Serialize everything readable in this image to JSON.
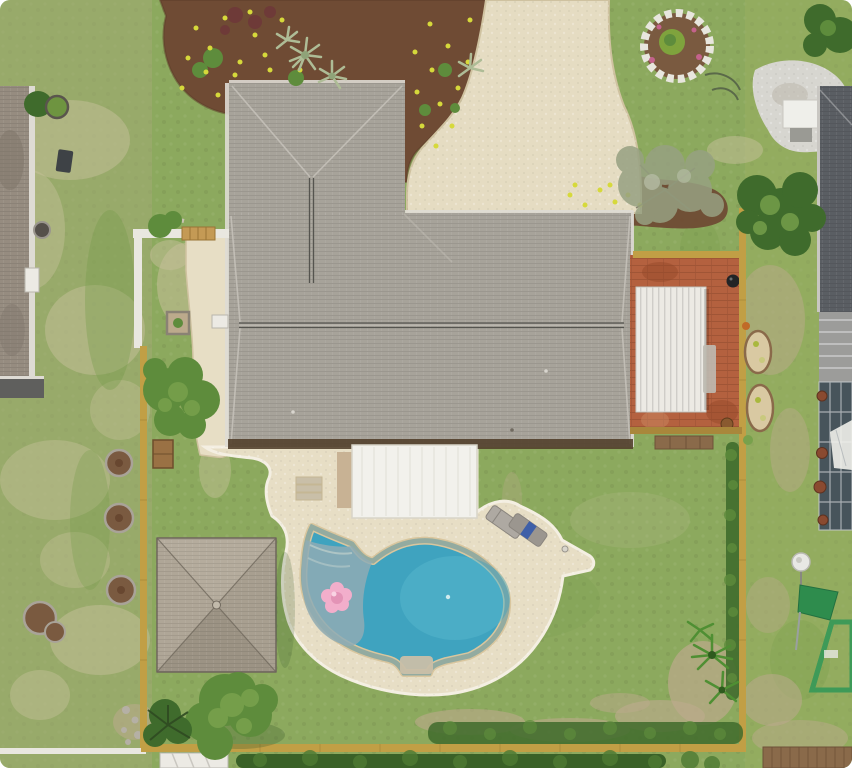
{
  "scene": {
    "type": "aerial-drone-photo",
    "alt": "Overhead aerial photo of a suburban home with gray shingle L-shaped roof, curved paver driveway, kidney-shaped swimming pool with pink float on a cream paver deck, square gazebo, red brick patio with white shed, yellow wood fencing, green lawns and garden beds with yellow flowers, flanked by neighboring houses on both sides."
  },
  "palette": {
    "grass_base": "#8CA95E",
    "grass_left": "#A3AC74",
    "grass_right": "#9BB061",
    "patch_dry": "#C6C099",
    "patch_dark": "#739A49",
    "dirt": "#BCAA8C",
    "mulch": "#6F4B34",
    "mulch_dark": "#5C3B27",
    "flower_yellow": "#D6D93B",
    "flower_red": "#6E3A38",
    "flower_pink": "#C4628C",
    "plant_green": "#7FA33D",
    "bush_dark": "#3F6B2C",
    "bush_mid": "#5E8C3C",
    "bush_light": "#78A14C",
    "sage": "#97A182",
    "agave": "#AEBC96",
    "roof_main": "#A7A39A",
    "roof_ridge": "#55544F",
    "roof_hip": "#C6C2BA",
    "roof_eave": "#53402C",
    "gutter_white": "#DEDBD4",
    "canopy": "#F2F1EC",
    "door_tan": "#C8B294",
    "deck": "#E7DEC5",
    "deck_edge": "#F4EFE2",
    "driveway": "#E5DCC2",
    "pool_coping": "#D9C69E",
    "pool_water": "#3FA3BF",
    "pool_water_light": "#58B8CE",
    "pool_shallow": "#8FACB4",
    "pool_steps": "#C9BFA8",
    "float_pink": "#F2AECB",
    "float_pink_dark": "#E393B6",
    "gazebo_n": "#B5AC9D",
    "gazebo_e": "#A89F90",
    "gazebo_s": "#9C9384",
    "gazebo_w": "#AFA697",
    "gazebo_line": "#71695E",
    "brick": "#B4613F",
    "shed_white": "#ECEAE4",
    "bench_gray": "#BFBBB2",
    "firepit_black": "#222426",
    "fence_yellow": "#C19F45",
    "fence_white": "#E9E7E0",
    "gate_wood": "#C49A55",
    "wood_box": "#9A7144",
    "wood_walk": "#8A6A4A",
    "gravel_white": "#D7D6D0",
    "awning_white": "#EFEFEA",
    "neighbor_left_roof": "#968C80",
    "left_shed_dark": "#5F5F5D",
    "chimney_white": "#ECEAE4",
    "ac_dark": "#3E4246",
    "stone_ring": "#A9A398",
    "mulch_circle": "#7A5A40",
    "neighbor_right_roof": "#5A5E63",
    "neighbor_right_roof2": "#9C9C9A",
    "enclosure": "#47545B",
    "enclosure_frame": "#C9CDD0",
    "pot_brown": "#8A4A30",
    "dish_white": "#E8E8E4",
    "playset_green": "#2E8C4D",
    "sand_planter": "#D9C9A2",
    "chair_gray": "#AEA9A2",
    "chair_gray2": "#9B968F",
    "towel_blue": "#3E5FA8",
    "stone_gray": "#B5B0A5"
  }
}
